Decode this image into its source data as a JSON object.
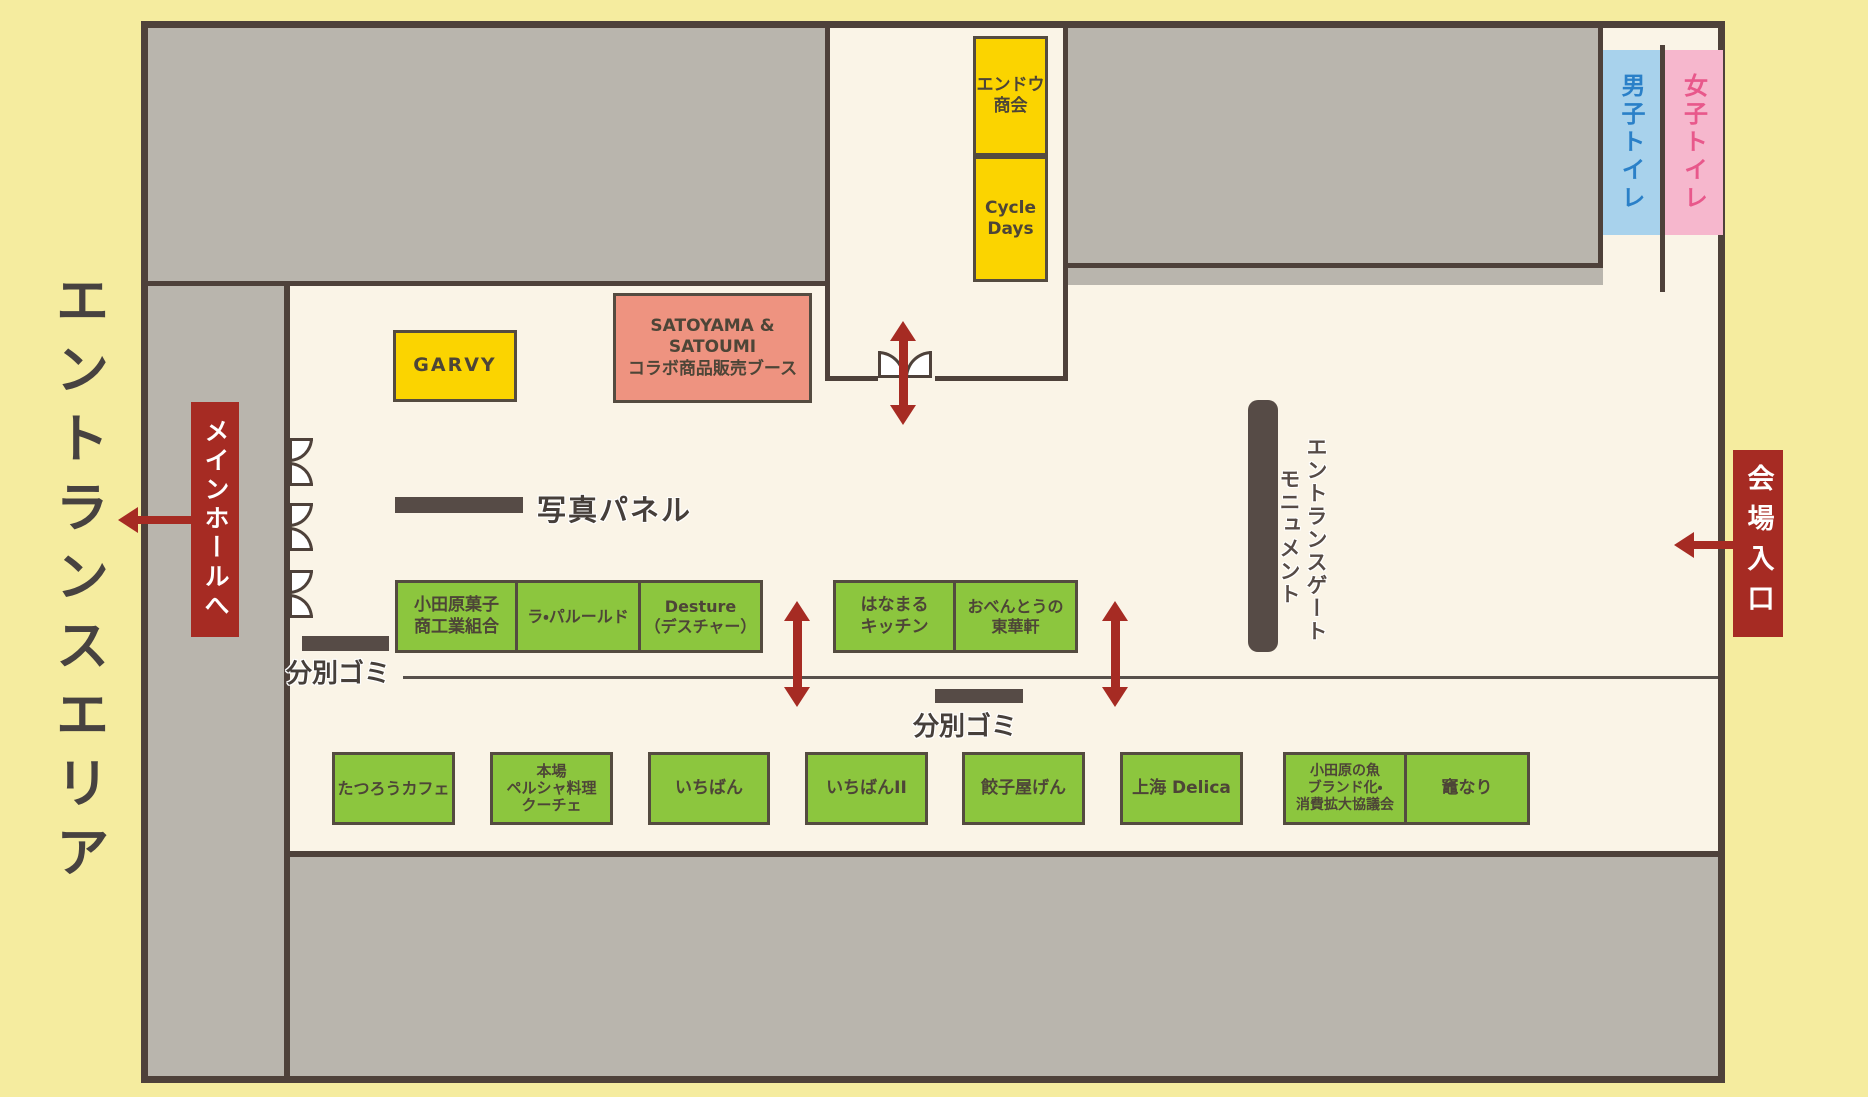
{
  "area": {
    "title": "エントランスエリア"
  },
  "badges": {
    "main_hall": "メインホールへ",
    "venue_entrance": "会場入口"
  },
  "toilets": {
    "mens": "男子トイレ",
    "womens": "女子トイレ"
  },
  "booths": {
    "endou": "エンドウ\n商会",
    "cycle_days": "Cycle\nDays",
    "garvy": "GARVY",
    "satoyama": "SATOYAMA & SATOUMI\nコラボ商品販売ブース",
    "green_row1": [
      "小田原菓子\n商工業組合",
      "ラ・パルールド",
      "Desture\n（デスチャー）",
      "はなまる\nキッチン",
      "おべんとうの\n東華軒"
    ],
    "green_row2": [
      "たつろうカフェ",
      "本場\nペルシャ料理\nクーチェ",
      "いちばん",
      "いちばんII",
      "餃子屋げん",
      "上海 Delica",
      "小田原の魚\nブランド化・\n消費拡大協議会",
      "竈なり"
    ]
  },
  "labels": {
    "photo_panel": "写真パネル",
    "trash_1": "分別ゴミ",
    "trash_2": "分別ゴミ",
    "monument_line1": "エントランスゲート",
    "monument_line2": "モニュメント"
  },
  "colors": {
    "background_yellow": "#f5ec9f",
    "wall_dark": "#4e413a",
    "gray_block": "#b9b5ad",
    "floor_cream": "#faf4e7",
    "booth_green": "#8cc63e",
    "booth_yellow": "#fbd400",
    "booth_salmon": "#ee9380",
    "accent_red": "#a62b23",
    "toilet_blue": "#a8d2ec",
    "toilet_blue_text": "#2a80c8",
    "toilet_pink": "#f6b7cd",
    "toilet_pink_text": "#e8588b"
  }
}
